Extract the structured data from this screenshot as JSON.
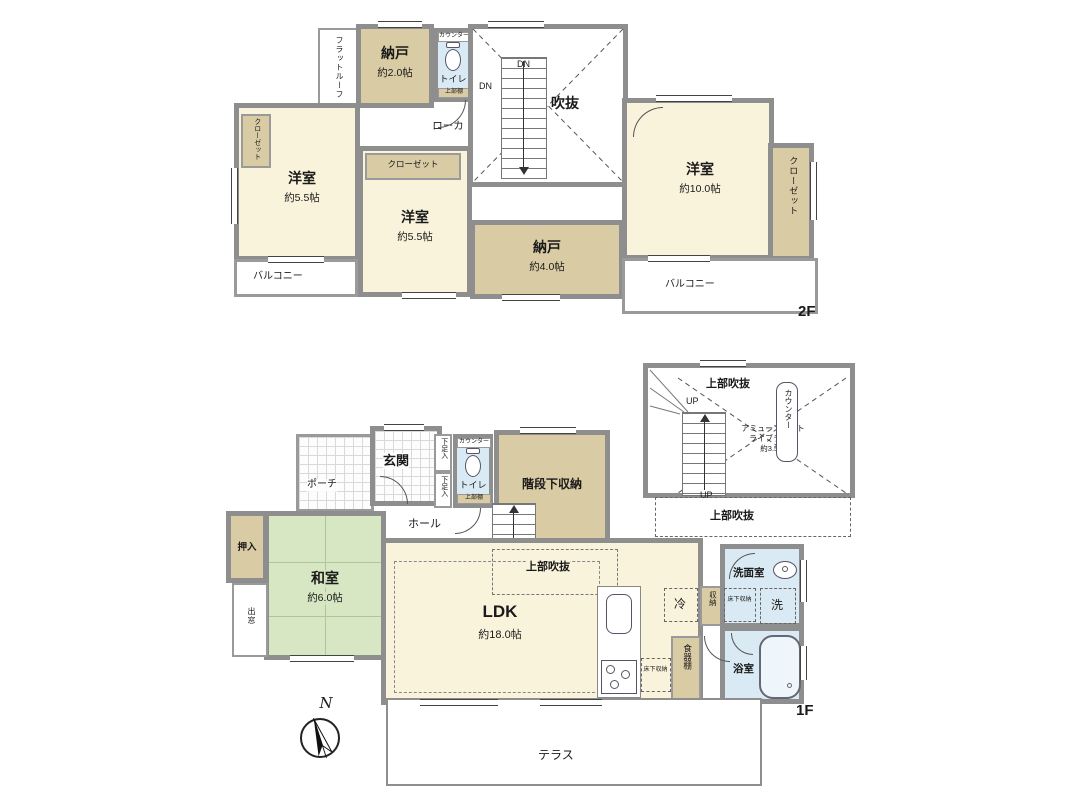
{
  "floor2": {
    "floor_label": "2F",
    "flat_roof": "フラットルーフ",
    "nando2": {
      "name": "納戸",
      "size": "約2.0帖"
    },
    "toilet": {
      "name": "トイレ",
      "counter": "カウンター",
      "shelf": "上部棚"
    },
    "stair": {
      "dn": "DN",
      "void": "吹抜"
    },
    "rouka": "ローカ",
    "yoshitsu_left": {
      "name": "洋室",
      "size": "約5.5帖",
      "closet": "クローゼット"
    },
    "yoshitsu_mid": {
      "name": "洋室",
      "size": "約5.5帖",
      "closet": "クローゼット"
    },
    "yoshitsu_right": {
      "name": "洋室",
      "size": "約10.0帖",
      "closet": "クローゼット"
    },
    "nando4": {
      "name": "納戸",
      "size": "約4.0帖"
    },
    "balcony_left": "バルコニー",
    "balcony_right": "バルコニー"
  },
  "floor1": {
    "floor_label": "1F",
    "porch": "ポーチ",
    "genkan": "玄関",
    "shoe_box": "下足入",
    "toilet": {
      "name": "トイレ",
      "counter": "カウンター",
      "shelf": "上部棚"
    },
    "stair_storage": "階段下収納",
    "hall": "ホール",
    "stairwell": {
      "up": "UP",
      "void_top": "上部吹抜",
      "void_bottom": "上部吹抜",
      "library_line1": "アミューズメント",
      "library_line2": "ライブラリー",
      "library_size": "約3.5帖",
      "counter": "カウンター"
    },
    "washitsu": {
      "name": "和室",
      "size": "約6.0帖",
      "oshiire": "押入",
      "demado": "出窓"
    },
    "ldk": {
      "name": "LDK",
      "size": "約18.0帖",
      "void": "上部吹抜",
      "up": "UP"
    },
    "fridge": "冷",
    "storage": "収納",
    "cupboard": "食器棚",
    "underfloor_kitchen": "床下収納",
    "underfloor_wash": "床下収納",
    "washroom": "洗面室",
    "washer": "洗",
    "bathroom": "浴室",
    "terrace": "テラス",
    "compass_north": "N"
  },
  "colors": {
    "wall": "#8e8e8e",
    "western_room": "#faf3dc",
    "storage_tan": "#d9cba4",
    "tatami_green": "#d7e6c3",
    "wet_area_blue": "#d9eaf4"
  }
}
